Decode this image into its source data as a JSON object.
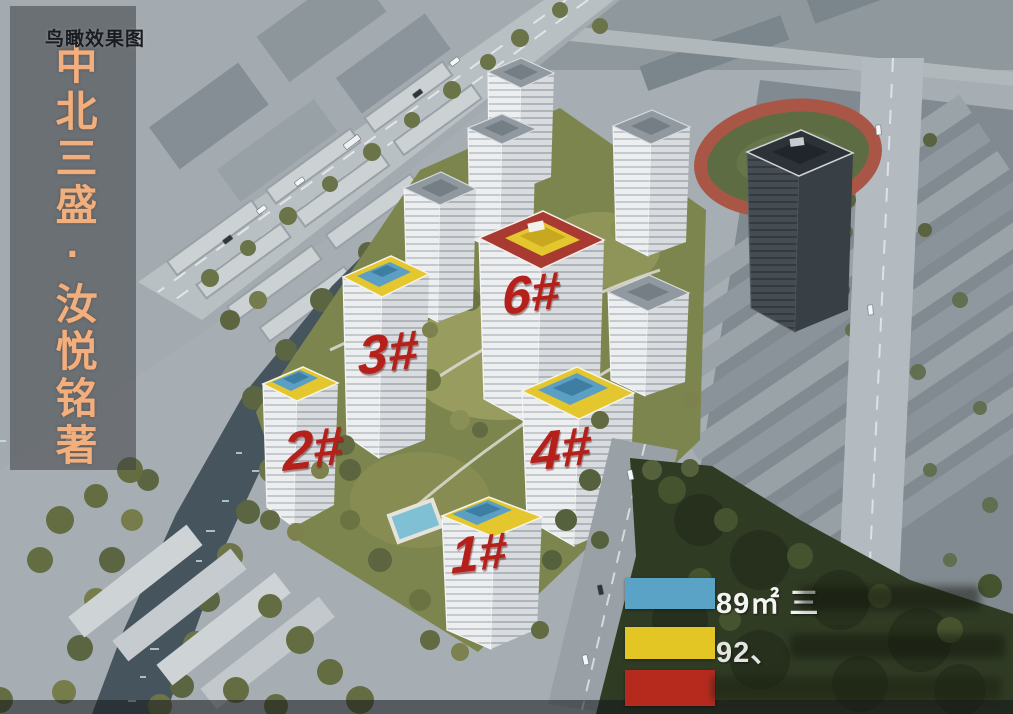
{
  "view_tag": {
    "label": "鸟瞰效果图"
  },
  "banner": {
    "title": "中北三盛·汝悦铭著",
    "text_color": "#f2ae7c"
  },
  "building_labels": {
    "b1": "1#",
    "b2": "2#",
    "b3": "3#",
    "b4": "4#",
    "b6": "6#",
    "label_color": "#b5201b"
  },
  "legend": {
    "rows": [
      {
        "swatch_color": "#5ba3c6",
        "text": "89㎡ 三"
      },
      {
        "swatch_color": "#e3c524",
        "text": "92、"
      },
      {
        "swatch_color": "#b62a1e",
        "text": ""
      }
    ]
  },
  "scene": {
    "roof_colors": {
      "blue": "#5b9fc4",
      "yellow": "#e4c72e",
      "red": "#a83a31"
    },
    "labeled_buildings": [
      "1#",
      "2#",
      "3#",
      "4#",
      "6#"
    ],
    "features": [
      "running-track",
      "river",
      "old-town",
      "industrial-sheds",
      "forest",
      "courtyard",
      "pool"
    ]
  }
}
